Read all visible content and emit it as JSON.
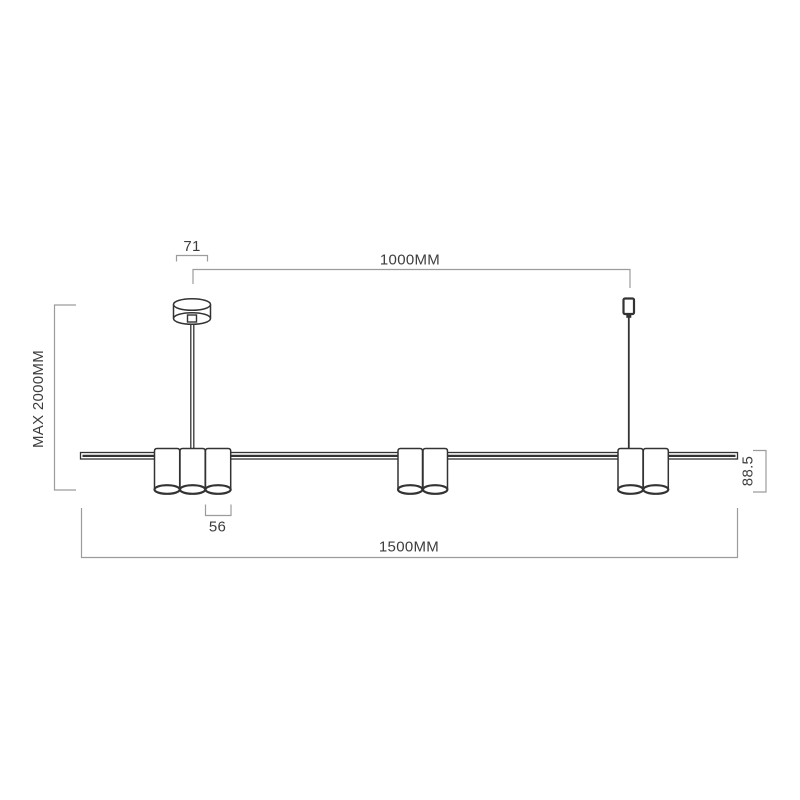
{
  "page": {
    "background": "#ffffff"
  },
  "colors": {
    "drawing_line": "#333333",
    "dimension_line": "#9c9c9c",
    "label_text": "#3d3d3d",
    "fill_white": "#ffffff"
  },
  "diagram": {
    "labels": {
      "canopy_width": "71",
      "suspension_spacing": "1000MM",
      "max_drop_height": "MAX 2000MM",
      "shade_width": "56",
      "fixture_height": "88.5",
      "total_length": "1500MM"
    },
    "shade_groups": [
      3,
      2,
      2
    ],
    "suspension_points": 2
  }
}
